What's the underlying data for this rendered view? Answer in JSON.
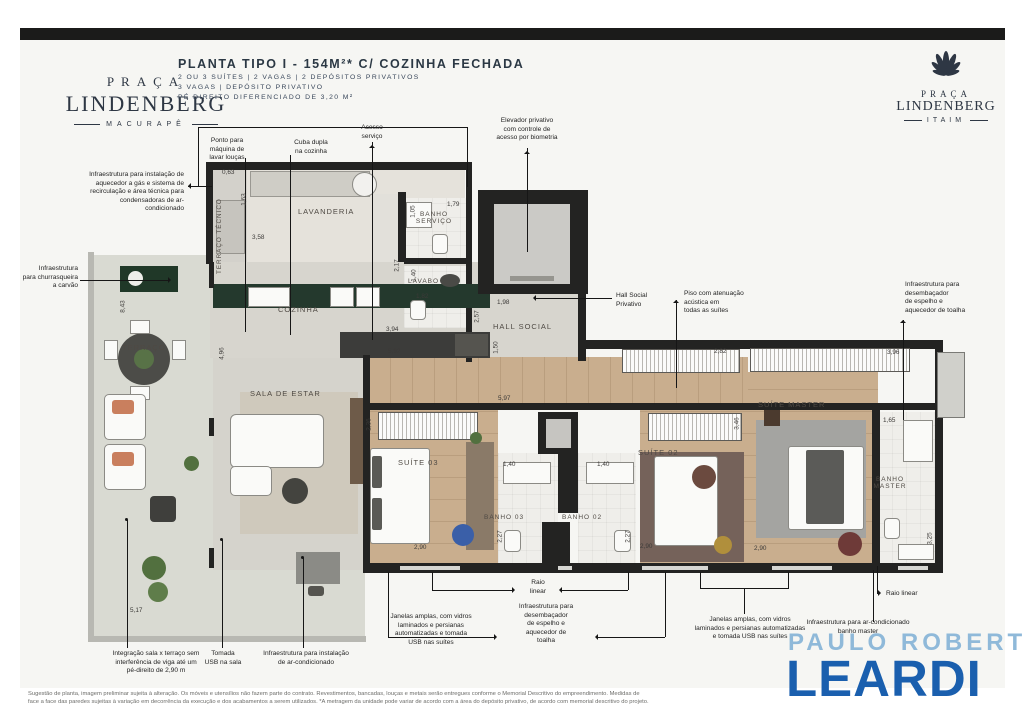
{
  "header": {
    "brand_left": {
      "line1": "PRAÇA",
      "line2": "LINDENBERG",
      "line3": "MACURAPÊ"
    },
    "brand_right": {
      "icon": "palm-fan-icon",
      "line1": "PRAÇA",
      "line2": "LINDENBERG",
      "line3": "ITAIM"
    },
    "title": "PLANTA TIPO I - 154M²* C/ COZINHA FECHADA",
    "subtitle1": "2 OU 3 SUÍTES | 2 VAGAS | 2 DEPÓSITOS PRIVATIVOS",
    "subtitle2": "3 VAGAS | DEPÓSITO PRIVATIVO",
    "subtitle3": "PÉ DIREITO DIFERENCIADO DE 3,20 M²"
  },
  "plan": {
    "room_labels": [
      {
        "t": "TERRAÇO TÉCNICO"
      },
      {
        "t": "LAVANDERIA"
      },
      {
        "t": "BANHO\nSERVIÇO"
      },
      {
        "t": "COZINHA"
      },
      {
        "t": "LAVABO"
      },
      {
        "t": "HALL SOCIAL"
      },
      {
        "t": "TERRAÇO"
      },
      {
        "t": "SALA DE ESTAR"
      },
      {
        "t": "SUÍTE 03"
      },
      {
        "t": "BANHO 03"
      },
      {
        "t": "BANHO 02"
      },
      {
        "t": "SUÍTE 02"
      },
      {
        "t": "SUÍTE MASTER"
      },
      {
        "t": "BANHO\nMASTER"
      }
    ],
    "dimensions": [
      {
        "v": "0,63"
      },
      {
        "v": "1,63"
      },
      {
        "v": "3,58"
      },
      {
        "v": "1,05"
      },
      {
        "v": "1,79"
      },
      {
        "v": "2,17"
      },
      {
        "v": "3,94"
      },
      {
        "v": "5,92"
      },
      {
        "v": "1,40"
      },
      {
        "v": "1,82"
      },
      {
        "v": "1,98"
      },
      {
        "v": "2,57"
      },
      {
        "v": "1,50"
      },
      {
        "v": "4,96"
      },
      {
        "v": "8,43"
      },
      {
        "v": "5,17"
      },
      {
        "v": "5,97"
      },
      {
        "v": "2,82"
      },
      {
        "v": "3,96"
      },
      {
        "v": "2,36"
      },
      {
        "v": "2,90"
      },
      {
        "v": "1,40"
      },
      {
        "v": "1,40"
      },
      {
        "v": "2,27"
      },
      {
        "v": "2,27"
      },
      {
        "v": "2,90"
      },
      {
        "v": "2,90"
      },
      {
        "v": "3,46"
      },
      {
        "v": "1,65"
      },
      {
        "v": "3,25"
      }
    ]
  },
  "annotations": [
    {
      "t": "Ponto para\nmáquina de\nlavar louças"
    },
    {
      "t": "Cuba dupla\nna cozinha"
    },
    {
      "t": "Acesso\nserviço"
    },
    {
      "t": "Elevador privativo\ncom controle de\nacesso por biometria"
    },
    {
      "t": "Infraestrutura para instalação de\naquecedor a gás e sistema de\nrecirculação e área técnica para\ncondensadoras de ar-condicionado"
    },
    {
      "t": "Infraestrutura\npara churrasqueira\na carvão"
    },
    {
      "t": "Hall Social\nPrivativo"
    },
    {
      "t": "Piso com atenuação\nacústica em\ntodas as suítes"
    },
    {
      "t": "Infraestrutura para\ndesembaçador\nde espelho e\naquecedor de toalha"
    },
    {
      "t": "Integração sala x terraço sem\ninterferência de viga até um\npé-direito de 2,90 m"
    },
    {
      "t": "Tomada\nUSB na sala"
    },
    {
      "t": "Infraestrutura para instalação\nde ar-condicionado"
    },
    {
      "t": "Janelas amplas, com vidros\nlaminados e persianas\nautomatizadas e tomada\nUSB nas suítes"
    },
    {
      "t": "Raio\nlinear"
    },
    {
      "t": "Infraestrutura para\ndesembaçador\nde espelho e\naquecedor de\ntoalha"
    },
    {
      "t": "Janelas amplas, com vidros\nlaminados e persianas automatizadas\ne tomada USB nas suítes"
    },
    {
      "t": "Raio linear"
    },
    {
      "t": "Infraestrutura para ar-condicionado\nbanho master"
    }
  ],
  "footer": {
    "legal1": "Sugestão de planta, imagem preliminar sujeita à alteração. Os móveis e utensílios não fazem parte do contrato. Revestimentos, bancadas, louças e metais serão entregues conforme o Memorial Descritivo do empreendimento. Medidas de",
    "legal2": "face a face das paredes sujeitas à variação em decorrência da execução e dos acabamentos a serem utilizados. *A metragem da unidade pode variar de acordo com a área do depósito privativo, de acordo com memorial descritivo do projeto."
  },
  "realtor": {
    "top": "PAULO ROBERTO",
    "main": "LEARDI"
  },
  "colors": {
    "top_bar": "#1b1b1a",
    "panel": "#f6f6f3",
    "wall": "#232322",
    "wood_floor": "#c9ae8e",
    "gray_floor": "#d7d5ce",
    "bath_floor": "#efeeea",
    "kitchen_counter": "#24392d",
    "brand_navy": "#2e3744",
    "realtor_light_blue": "#8fb9d9",
    "realtor_blue": "#1a5fae"
  }
}
